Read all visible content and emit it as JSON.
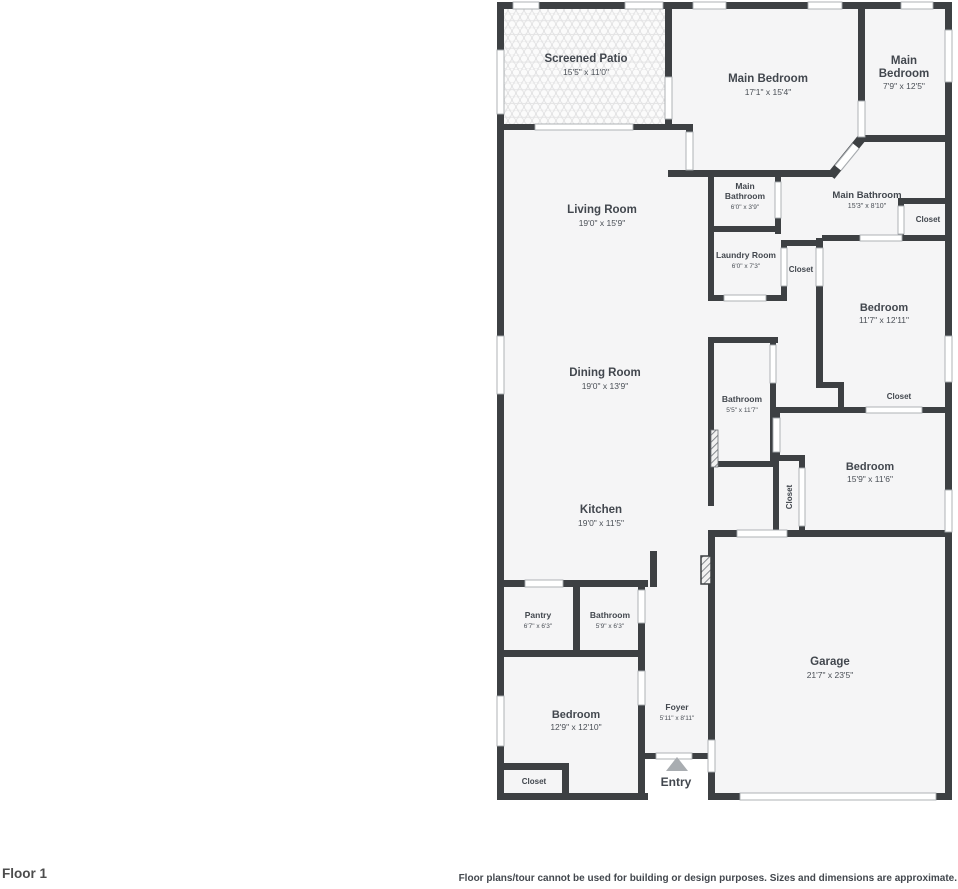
{
  "app": {
    "floor_label": "Floor 1",
    "disclaimer": "Floor plans/tour cannot be used for building or design purposes. Sizes and dimensions are approximate."
  },
  "colors": {
    "wall": "#3d4043",
    "room_fill": "#f5f5f6",
    "door_jamb": "#a7abaf",
    "text": "#42474e",
    "entry_arrow": "#a9adb1"
  },
  "rooms": {
    "screened_patio": {
      "name": "Screened Patio",
      "dims": "15'5\" x 11'0\""
    },
    "main_bedroom": {
      "name": "Main Bedroom",
      "dims": "17'1\" x 15'4\""
    },
    "main_bedroom_2": {
      "name_line1": "Main",
      "name_line2": "Bedroom",
      "dims": "7'9\" x 12'5\""
    },
    "main_bathroom_small": {
      "name_line1": "Main",
      "name_line2": "Bathroom",
      "dims": "6'0\" x 3'9\""
    },
    "main_bathroom": {
      "name": "Main Bathroom",
      "dims": "15'3\" x 8'10\""
    },
    "closet_main_bath": {
      "name": "Closet"
    },
    "laundry_room": {
      "name": "Laundry Room",
      "dims": "6'0\" x 7'3\""
    },
    "closet_hall": {
      "name": "Closet"
    },
    "bedroom_ne": {
      "name": "Bedroom",
      "dims": "11'7\" x 12'11\""
    },
    "living_room": {
      "name": "Living Room",
      "dims": "19'0\" x 15'9\""
    },
    "dining_room": {
      "name": "Dining Room",
      "dims": "19'0\" x 13'9\""
    },
    "bathroom_hall": {
      "name": "Bathroom",
      "dims": "5'5\" x 11'7\""
    },
    "closet_bedroom_ne": {
      "name": "Closet"
    },
    "closet_bedroom_e": {
      "name": "Closet"
    },
    "bedroom_e": {
      "name": "Bedroom",
      "dims": "15'9\" x 11'6\""
    },
    "kitchen": {
      "name": "Kitchen",
      "dims": "19'0\" x 11'5\""
    },
    "pantry": {
      "name": "Pantry",
      "dims": "6'7\" x 6'3\""
    },
    "bathroom_sw": {
      "name": "Bathroom",
      "dims": "5'9\" x 6'3\""
    },
    "bedroom_sw": {
      "name": "Bedroom",
      "dims": "12'9\" x 12'10\""
    },
    "closet_bedroom_sw": {
      "name": "Closet"
    },
    "foyer": {
      "name": "Foyer",
      "dims": "5'11\" x 8'11\""
    },
    "entry": {
      "name": "Entry"
    },
    "garage": {
      "name": "Garage",
      "dims": "21'7\" x 23'5\""
    }
  }
}
